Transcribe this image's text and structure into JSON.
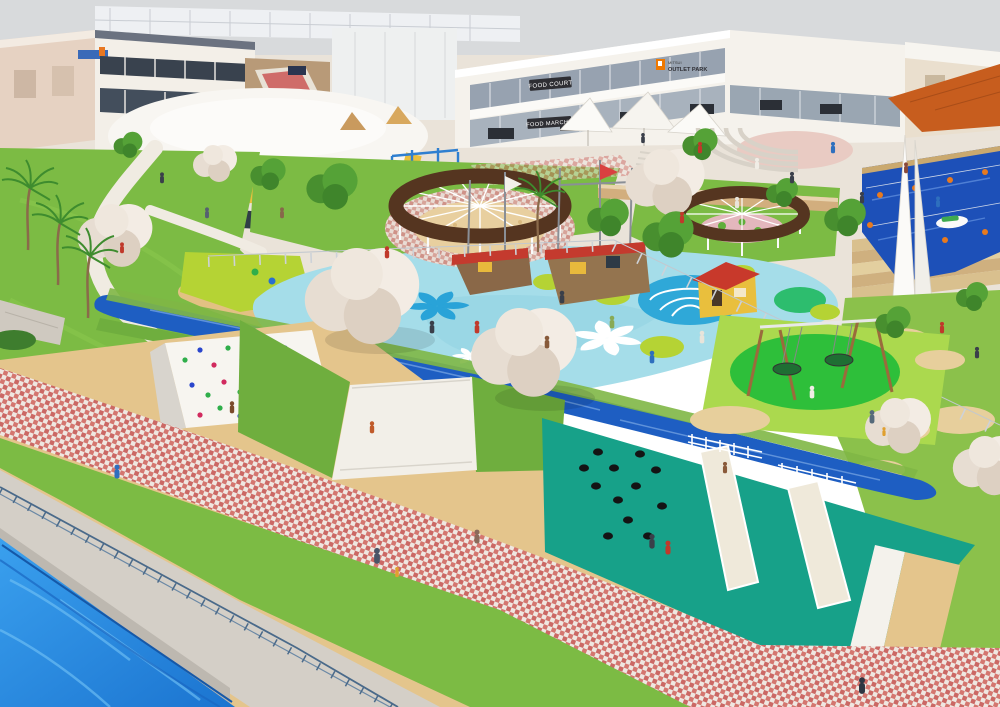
{
  "scene": {
    "title": "Aerial architectural rendering of a waterfront outlet mall with splash-pad playground park",
    "view": "3D visualization, high-angle aerial view"
  },
  "signs": {
    "food_court": "FOOD COURT",
    "food_marche": "FOOD MARCHE",
    "brand_top": "MITSUI",
    "brand_name": "OUTLET PARK"
  },
  "palette": {
    "sky": "#d8dadc",
    "plaza": "#eae3d9",
    "facade": "#f5f2ec",
    "facade_right": "#eadfce",
    "stripe_yellow": "#e9bf3d",
    "sign_dark": "#2e2e33",
    "brand_orange": "#ee7800",
    "roof_orange": "#c75d1e",
    "lawn": "#7cbb44",
    "lawn_light": "#9ccc55",
    "splash_pad": "#a5dde9",
    "splash_motif": "#2fa8d8",
    "pond_blue": "#2166c4",
    "river": "#1e5ec2",
    "canal": "#2388e0",
    "pool": "#1d50b8",
    "teal_slope": "#17a189",
    "rubber_green": "#2ebf3a",
    "rubber_lime": "#abd94e",
    "lime_motif": "#b5d334",
    "sand": "#e4c58c",
    "paver_red": "#c4524e",
    "pergola_roof": "#553520",
    "amphi_circle": "#e9cbc3",
    "terrace_tan": "#d2ae7e",
    "pink_ring": "#d9a8a0",
    "slide_white": "#f2efe8",
    "wall_white": "#f7f5f0",
    "cherry_tree": "#ece4da",
    "tree_green": "#4f9a33"
  }
}
